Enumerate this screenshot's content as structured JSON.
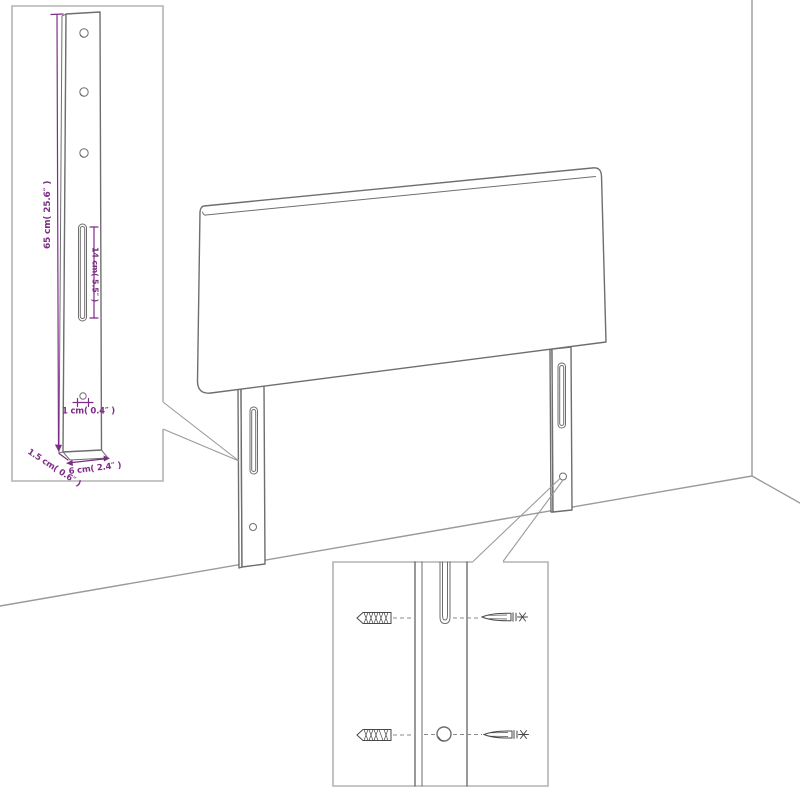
{
  "diagram": {
    "subject": "headboard-wall-mounting-diagram",
    "colors": {
      "background": "#ffffff",
      "product_line": "#6e6e6e",
      "room_line": "#9a9a9a",
      "inset_border": "#b3b3b3",
      "dimension_accent": "#7d2d87",
      "hardware_line": "#4a4a4a"
    },
    "leg_detail_inset": {
      "dim_height": "65 cm( 25.6″ )",
      "dim_slot": "14 cm( 5.5″ )",
      "dim_hole": "1 cm( 0.4″ )",
      "dim_depth": "1.5 cm( 0.6″ )",
      "dim_width": "6 cm( 2.4″ )"
    },
    "mounting_inset": {
      "hardware_icons": [
        "wall-anchor-icon",
        "screw-icon"
      ]
    }
  }
}
